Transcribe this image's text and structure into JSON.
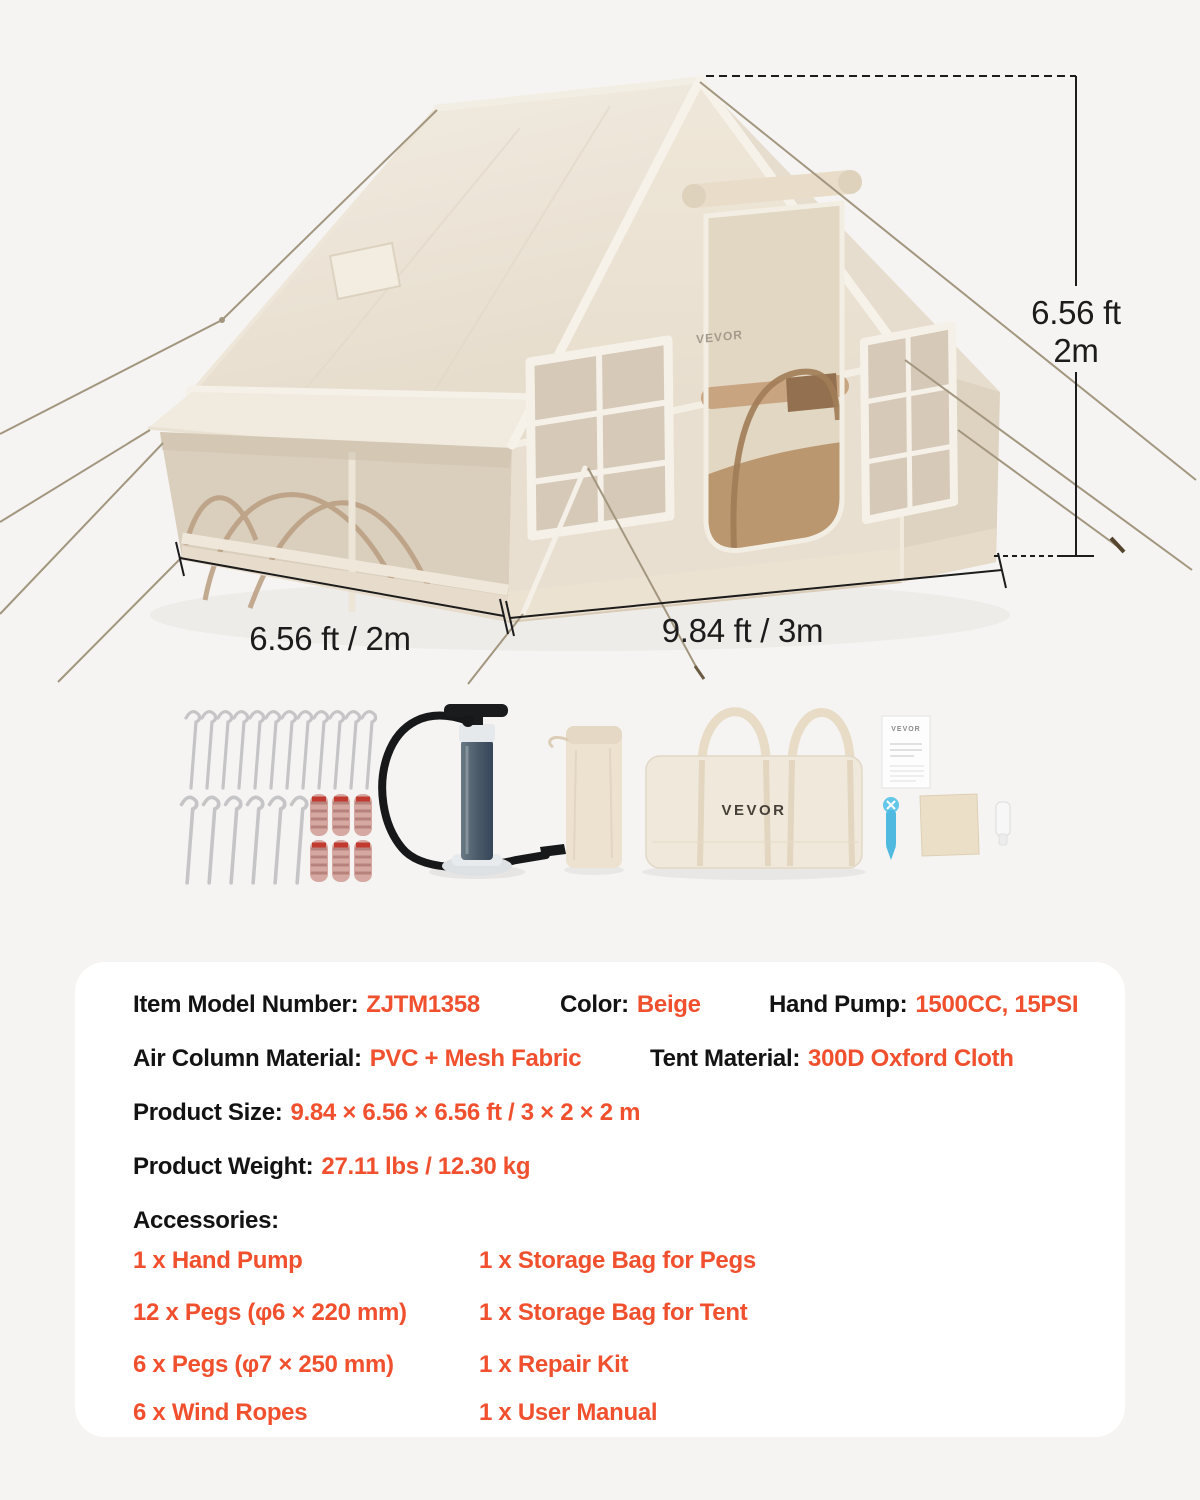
{
  "theme": {
    "page_background": "#f5f4f2",
    "card_background": "#ffffff",
    "accent_orange": "#f0502e",
    "text_black": "#131313",
    "tent_beige": "#e9dfd0",
    "dimension_line": "#1c1c1c"
  },
  "hero": {
    "dimensions": {
      "height_line1": "6.56 ft",
      "height_line2": "2m",
      "width_label": "6.56 ft / 2m",
      "length_label": "9.84 ft / 3m"
    },
    "tent_logo": "VEVOR",
    "bag_logo": "VEVOR",
    "manual_logo": "VEVOR"
  },
  "specs": {
    "rows": [
      {
        "label": "Item Model Number:",
        "value": "ZJTM1358"
      },
      {
        "label": "Color:",
        "value": "Beige"
      },
      {
        "label": "Hand Pump:",
        "value": "1500CC, 15PSI"
      },
      {
        "label": "Air Column Material:",
        "value": "PVC + Mesh Fabric"
      },
      {
        "label": "Tent Material:",
        "value": "300D Oxford Cloth"
      },
      {
        "label": "Product Size:",
        "value": "9.84 × 6.56 × 6.56 ft / 3 × 2 × 2 m"
      },
      {
        "label": "Product Weight:",
        "value": "27.11 lbs / 12.30 kg"
      }
    ],
    "accessories_title": "Accessories:",
    "accessories_col1": [
      "1 x Hand Pump",
      "12 x Pegs (φ6 × 220 mm)",
      "6 x Pegs (φ7 × 250 mm)",
      "6 x Wind Ropes"
    ],
    "accessories_col2": [
      "1 x Storage Bag for Pegs",
      "1 x Storage Bag for Tent",
      "1 x Repair Kit",
      "1 x User Manual"
    ]
  }
}
